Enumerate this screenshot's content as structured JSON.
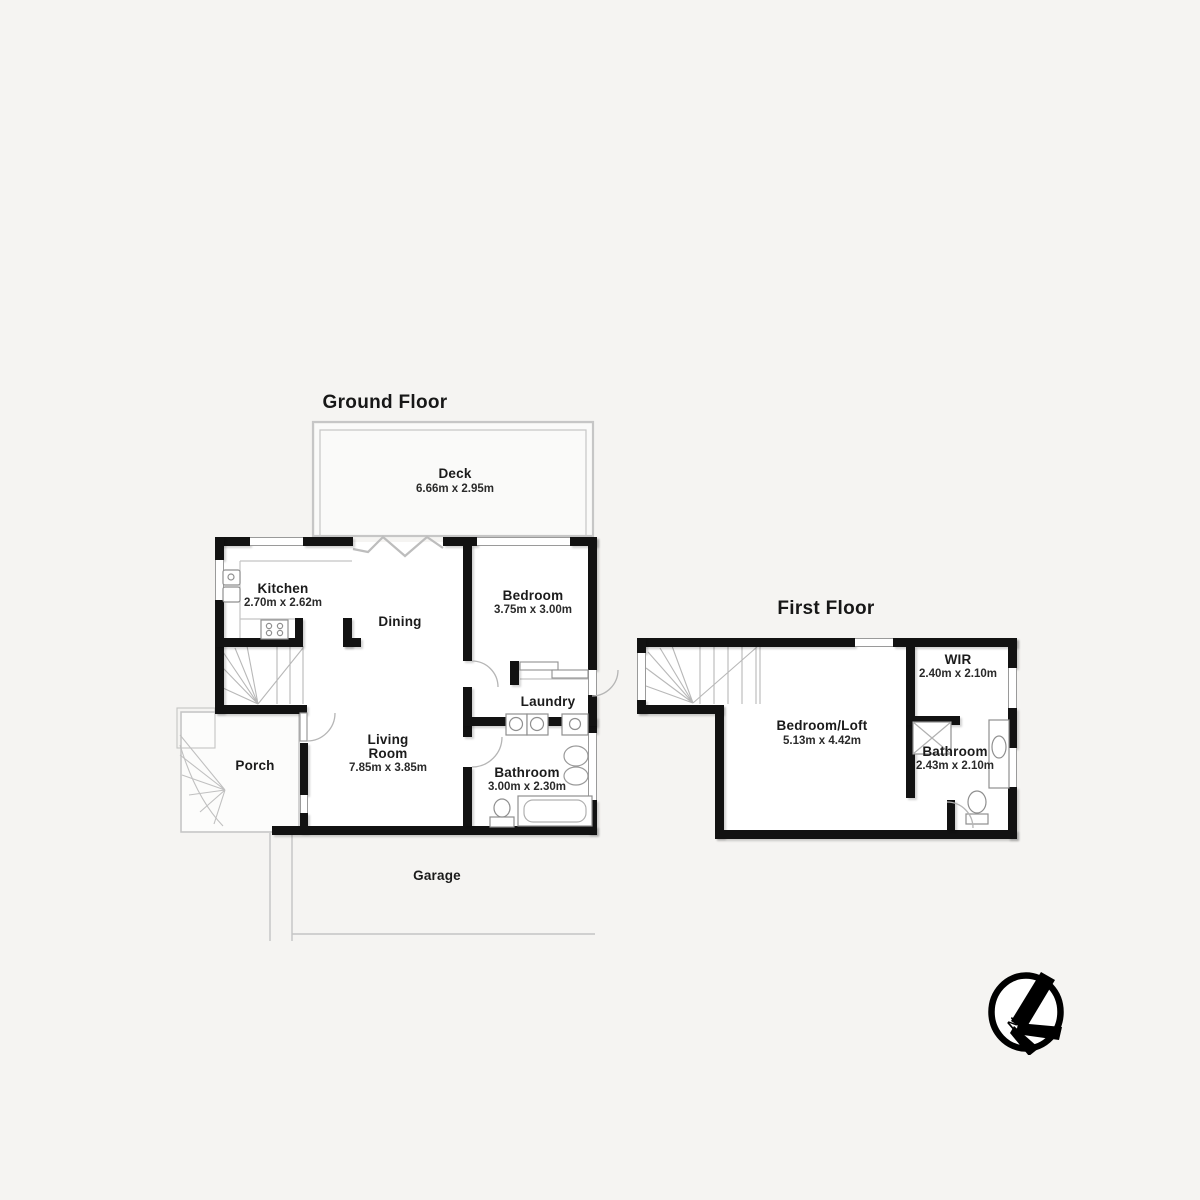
{
  "colors": {
    "wall": "#121212",
    "thin_line": "#c2c2c2",
    "text": "#1b1b1b",
    "background": "#f5f4f2",
    "room_fill": "#ffffff",
    "logo": "#000000"
  },
  "ground_floor": {
    "title": "Ground Floor",
    "rooms": {
      "deck": {
        "name": "Deck",
        "dims": "6.66m x 2.95m"
      },
      "kitchen": {
        "name": "Kitchen",
        "dims": "2.70m x 2.62m"
      },
      "dining": {
        "name": "Dining"
      },
      "bedroom": {
        "name": "Bedroom",
        "dims": "3.75m x 3.00m"
      },
      "laundry": {
        "name": "Laundry"
      },
      "living_room": {
        "name": "Living Room",
        "dims": "7.85m x 3.85m"
      },
      "porch": {
        "name": "Porch"
      },
      "bathroom": {
        "name": "Bathroom",
        "dims": "3.00m x 2.30m"
      },
      "garage": {
        "name": "Garage"
      }
    }
  },
  "first_floor": {
    "title": "First Floor",
    "rooms": {
      "bedroom_loft": {
        "name": "Bedroom/Loft",
        "dims": "5.13m x 4.42m"
      },
      "wir": {
        "name": "WIR",
        "dims": "2.40m x 2.10m"
      },
      "bathroom": {
        "name": "Bathroom",
        "dims": "2.43m x 2.10m"
      }
    }
  },
  "watermark": {
    "compass_letter": "N"
  }
}
